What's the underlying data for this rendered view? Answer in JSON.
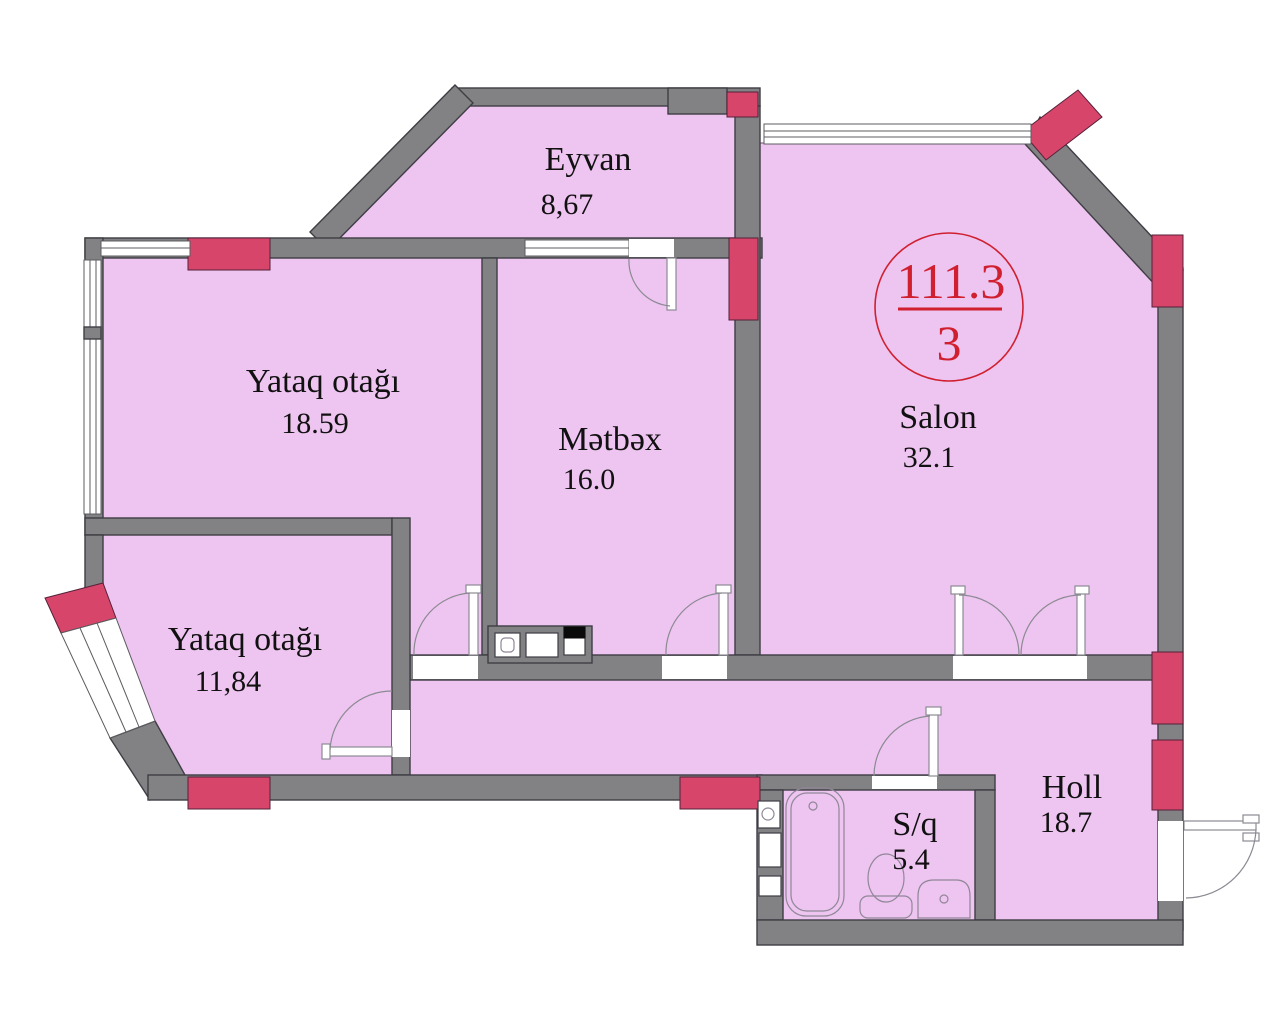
{
  "rooms": [
    {
      "id": "eyvan",
      "name": "Eyvan",
      "area": "8,67"
    },
    {
      "id": "bedroom-1",
      "name": "Yataq otağı",
      "area": "18.59"
    },
    {
      "id": "kitchen",
      "name": "Mətbəx",
      "area": "16.0"
    },
    {
      "id": "salon",
      "name": "Salon",
      "area": "32.1"
    },
    {
      "id": "bedroom-2",
      "name": "Yataq otağı",
      "area": "11,84"
    },
    {
      "id": "bathroom",
      "name": "S/q",
      "area": "5.4"
    },
    {
      "id": "hall",
      "name": "Holl",
      "area": "18.7"
    }
  ],
  "stamp": {
    "total_area": "111.3",
    "room_count": "3"
  },
  "colors": {
    "room_fill": "#eec4f0",
    "wall_gray": "#828284",
    "accent_red": "#d7466a",
    "stamp_red": "#d02030",
    "outline": "#3d3d44"
  }
}
